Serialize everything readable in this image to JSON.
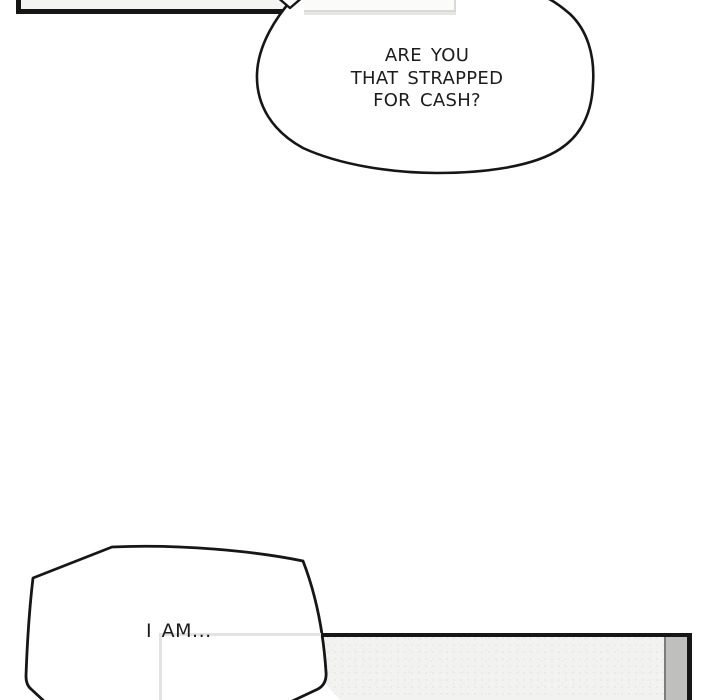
{
  "comic": {
    "top_bubble": {
      "line1": "ARE YOU",
      "line2": "THAT STRAPPED",
      "line3": "FOR CASH?"
    },
    "bottom_bubble": {
      "text": "I AM..."
    }
  },
  "colors": {
    "page_background": "#ffffff",
    "ink_outline": "#161616",
    "text": "#1c1c1c",
    "top_left_panel_fill": "#f4f4f2",
    "top_white_panel_fill": "#fbfbfa",
    "top_white_panel_border": "#d9d9d7",
    "gray_panel_fill": "#f2f2f0",
    "gray_wall_strip": "#bfbfbd",
    "gray_wall_edge": "#7c7c7a",
    "inner_frame_border": "#e3e3e1"
  }
}
